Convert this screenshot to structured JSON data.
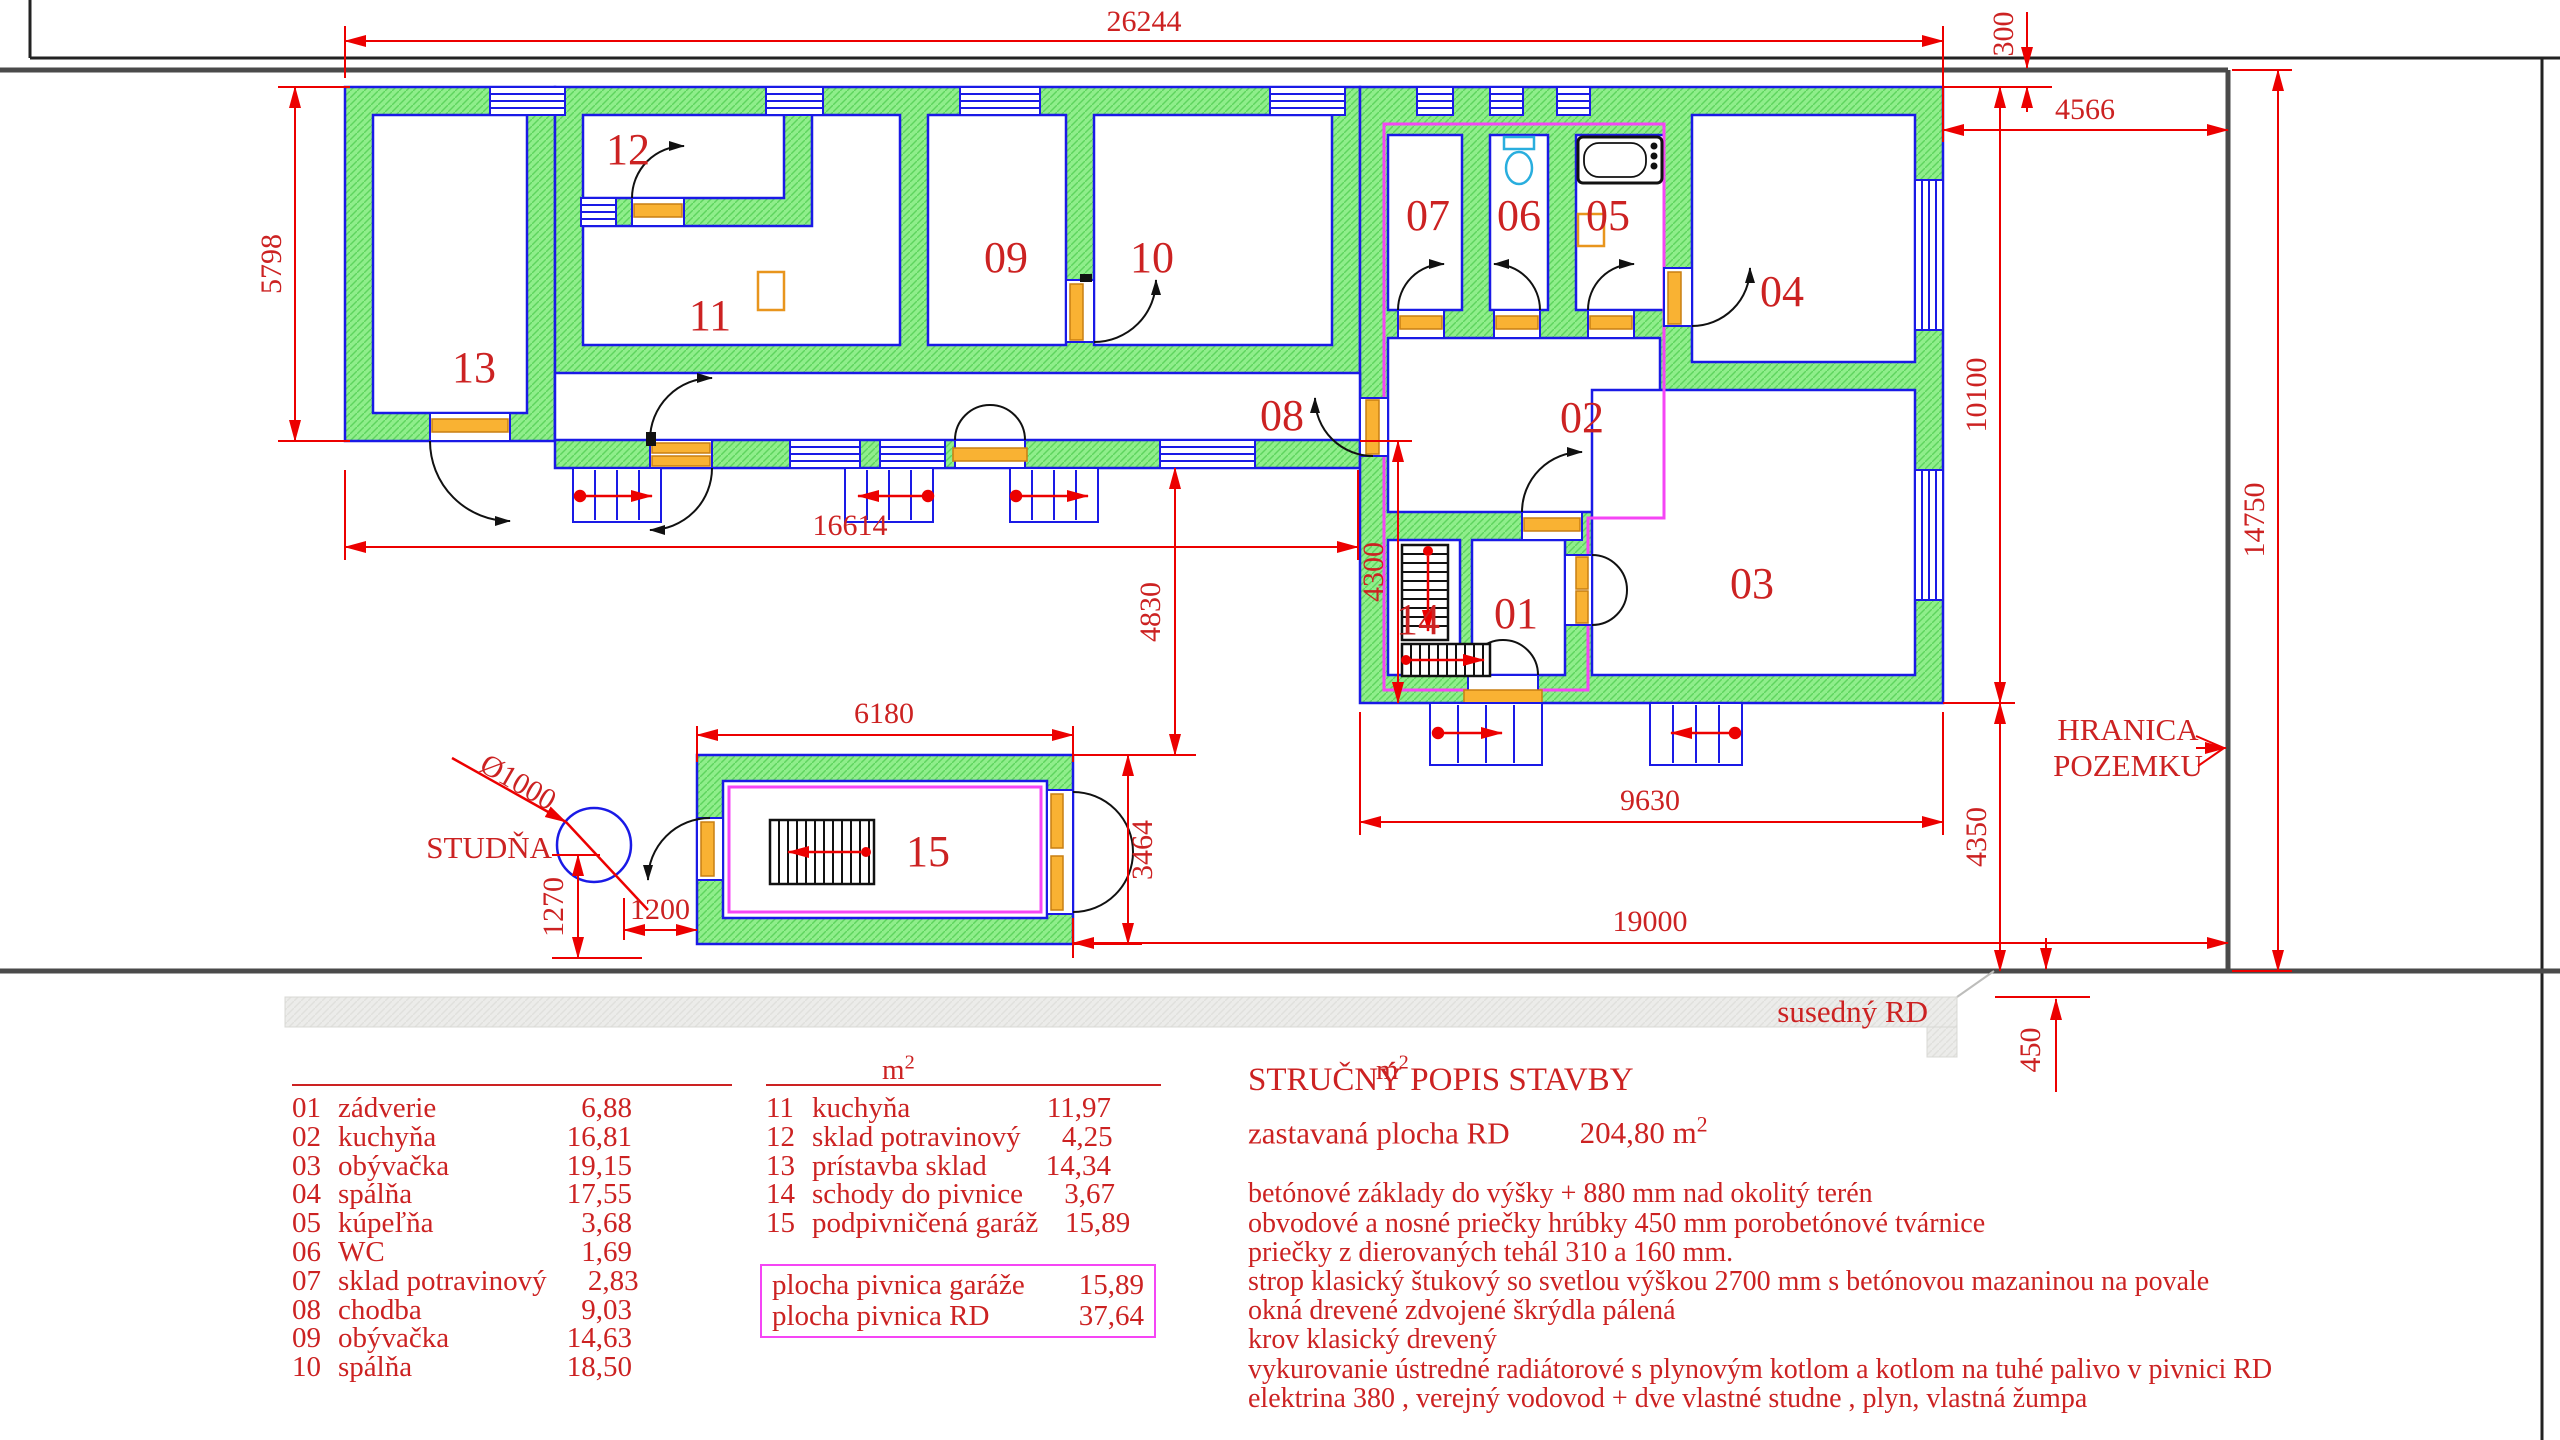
{
  "plan": {
    "rooms": {
      "r01": "01",
      "r02": "02",
      "r03": "03",
      "r04": "04",
      "r05": "05",
      "r06": "06",
      "r07": "07",
      "r08": "08",
      "r09": "09",
      "r10": "10",
      "r11": "11",
      "r12": "12",
      "r13": "13",
      "r14": "14",
      "r15": "15"
    },
    "dims": {
      "total_width": "26244",
      "top_offset": "300",
      "right_offset": "4566",
      "left_height": "5798",
      "left_width": "16614",
      "house_garage_gap": "4830",
      "level_offset": "4300",
      "right_height": "10100",
      "site_height": "14750",
      "south_gap": "4350",
      "right_width": "9630",
      "bottom_span": "19000",
      "garage_width": "6180",
      "garage_height": "3464",
      "well_south": "1270",
      "well_east": "1200",
      "well_diameter": "Ø1000",
      "neighbor_gap": "450"
    },
    "labels": {
      "well": "STUDŇA",
      "boundary_line1": "HRANICA",
      "boundary_line2": "POZEMKU",
      "neighbor_house": "susedný RD"
    }
  },
  "legend_left": {
    "unit": "m",
    "unit_sup": "2",
    "rows": [
      {
        "no": "01",
        "name": "zádverie",
        "area": "6,88"
      },
      {
        "no": "02",
        "name": "kuchyňa",
        "area": "16,81"
      },
      {
        "no": "03",
        "name": "obývačka",
        "area": "19,15"
      },
      {
        "no": "04",
        "name": "spálňa",
        "area": "17,55"
      },
      {
        "no": "05",
        "name": "kúpeľňa",
        "area": "3,68"
      },
      {
        "no": "06",
        "name": "WC",
        "area": "1,69"
      },
      {
        "no": "07",
        "name": "sklad potravinový",
        "area": "2,83"
      },
      {
        "no": "08",
        "name": "chodba",
        "area": "9,03"
      },
      {
        "no": "09",
        "name": "obývačka",
        "area": "14,63"
      },
      {
        "no": "10",
        "name": "spálňa",
        "area": "18,50"
      }
    ]
  },
  "legend_right": {
    "unit": "m",
    "unit_sup": "2",
    "rows": [
      {
        "no": "11",
        "name": "kuchyňa",
        "area": "11,97"
      },
      {
        "no": "12",
        "name": "sklad potravinový",
        "area": "4,25"
      },
      {
        "no": "13",
        "name": "prístavba sklad",
        "area": "14,34"
      },
      {
        "no": "14",
        "name": "schody do pivnice",
        "area": "3,67"
      },
      {
        "no": "15",
        "name": "podpivničená garáž",
        "area": "15,89"
      }
    ]
  },
  "cellar_box": {
    "rows": [
      {
        "name": "plocha pivnica garáže",
        "area": "15,89"
      },
      {
        "name": "plocha pivnica RD",
        "area": "37,64"
      }
    ]
  },
  "description": {
    "title": "STRUČNÝ POPIS STAVBY",
    "built_label": "zastavaná plocha RD",
    "built_value": "204,80",
    "built_unit": "m",
    "built_unit_sup": "2",
    "lines": [
      "betónové základy do výšky + 880 mm nad okolitý terén",
      "obvodové a nosné priečky hrúbky 450 mm porobetónové tvárnice",
      "priečky z dierovaných tehál 310 a 160 mm.",
      "strop klasický štukový so svetlou výškou 2700 mm s betónovou mazaninou na povale",
      "okná drevené zdvojené  škrýdla pálená",
      "krov klasický drevený",
      "vykurovanie ústredné radiátorové s plynovým kotlom a kotlom na tuhé palivo v pivnici RD",
      "elektrina 380 , verejný vodovod + dve vlastné studne , plyn, vlastná žumpa"
    ]
  }
}
